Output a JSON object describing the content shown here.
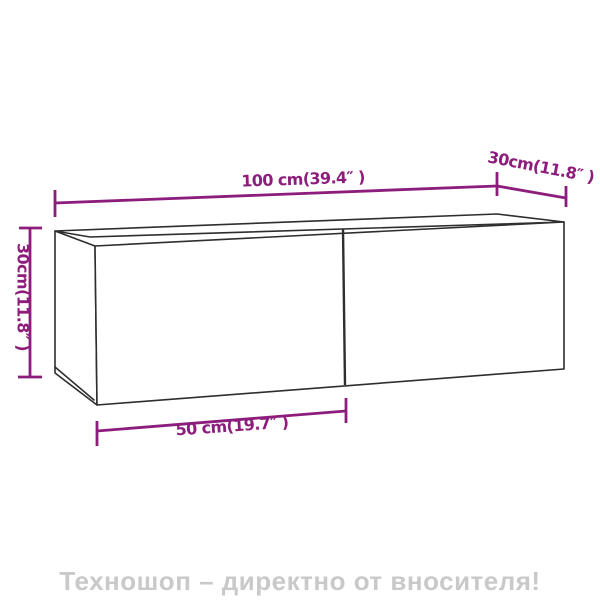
{
  "diagram": {
    "labels": {
      "width": "100 cm(39.4″ )",
      "depth": "30cm(11.8″ )",
      "height": "30cm(11.8″ )",
      "door_width": "50 cm(19.7″ )"
    },
    "measurements": {
      "width_cm": 100,
      "width_in": 39.4,
      "depth_cm": 30,
      "depth_in": 11.8,
      "height_cm": 30,
      "height_in": 11.8,
      "door_width_cm": 50,
      "door_width_in": 19.7
    },
    "colors": {
      "dimension_line": "#8d1d7c",
      "outline": "#2e2e2e",
      "watermark": "#c9c9c9",
      "background": "#ffffff"
    }
  },
  "footer": {
    "watermark": "Техношоп – директно от вносителя!"
  }
}
